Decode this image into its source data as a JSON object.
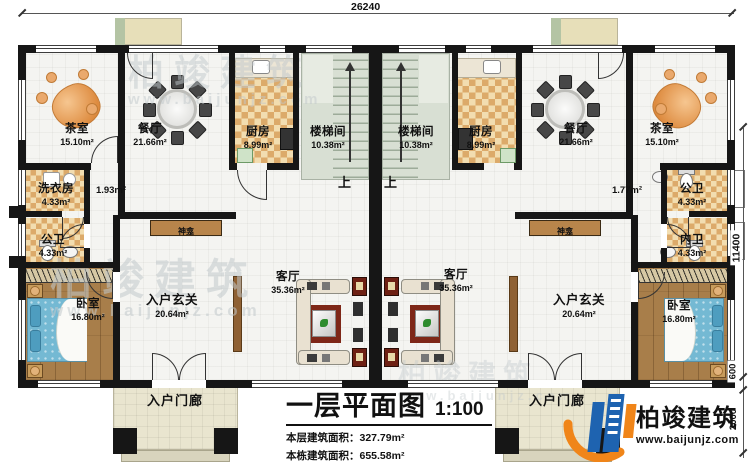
{
  "plan": {
    "dim_top": "26240",
    "dim_right_main": "11400",
    "dim_right_step": "600",
    "dim_right_porch": "2000",
    "stair_up_left": "上",
    "stair_up_right": "上"
  },
  "rooms": {
    "tea_l": {
      "name": "茶室",
      "area": "15.10m²"
    },
    "dining_l": {
      "name": "餐厅",
      "area": "21.66m²"
    },
    "kitchen_l": {
      "name": "厨房",
      "area": "8.99m²"
    },
    "stair_l": {
      "name": "楼梯间",
      "area": "10.38m²"
    },
    "laundry_l": {
      "name": "洗衣房",
      "area": "4.33m²"
    },
    "corridor_l": {
      "area": "1.93m²"
    },
    "pubbath_l": {
      "name": "公卫",
      "area": "4.33m²"
    },
    "bedroom_l": {
      "name": "卧室",
      "area": "16.80m²"
    },
    "foyer_l": {
      "name": "入户玄关",
      "area": "20.64m²"
    },
    "living_l": {
      "name": "客厅",
      "area": "35.36m²"
    },
    "shrine_l": {
      "name": "神龛"
    },
    "porch_l": {
      "name": "入户门廊"
    },
    "stair_r": {
      "name": "楼梯间",
      "area": "10.38m²"
    },
    "kitchen_r": {
      "name": "厨房",
      "area": "8.99m²"
    },
    "dining_r": {
      "name": "餐厅",
      "area": "21.66m²"
    },
    "tea_r": {
      "name": "茶室",
      "area": "15.10m²"
    },
    "pubbath_r": {
      "name": "公卫",
      "area": "4.33m²"
    },
    "corridor_r": {
      "area": "1.77m²"
    },
    "inbath_r": {
      "name": "内卫",
      "area": "4.33m²"
    },
    "bedroom_r": {
      "name": "卧室",
      "area": "16.80m²"
    },
    "foyer_r": {
      "name": "入户玄关",
      "area": "20.64m²"
    },
    "living_r": {
      "name": "客厅",
      "area": "35.36m²"
    },
    "shrine_r": {
      "name": "神龛"
    },
    "porch_r": {
      "name": "入户门廊"
    }
  },
  "title_block": {
    "title": "一层平面图",
    "scale": "1:100",
    "row1_label": "本层建筑面积：",
    "row1_value": "327.79m²",
    "row2_label": "本栋建筑面积：",
    "row2_value": "655.58m²",
    "row3_label": "占地面积：",
    "row3_value": "341.02m²",
    "row3b_label": "层高：",
    "row3b_value": "3.9m"
  },
  "logo": {
    "company": "柏竣建筑",
    "website": "www.baijunjz.com"
  },
  "watermark": {
    "brand": "柏竣建筑",
    "site": "www.baijunjz.com"
  },
  "colors": {
    "wall": "#161616",
    "checker_dark": "#dcaa6a",
    "checker_light": "#f2ddb0",
    "wood": "#a87e4a",
    "accent_red": "#6e2013",
    "bed_blue": "#74b9d3",
    "stair": "#d8dfd3",
    "porch": "#e9e5cf",
    "logo_blue": "#1e63b0",
    "logo_orange": "#f08519"
  }
}
